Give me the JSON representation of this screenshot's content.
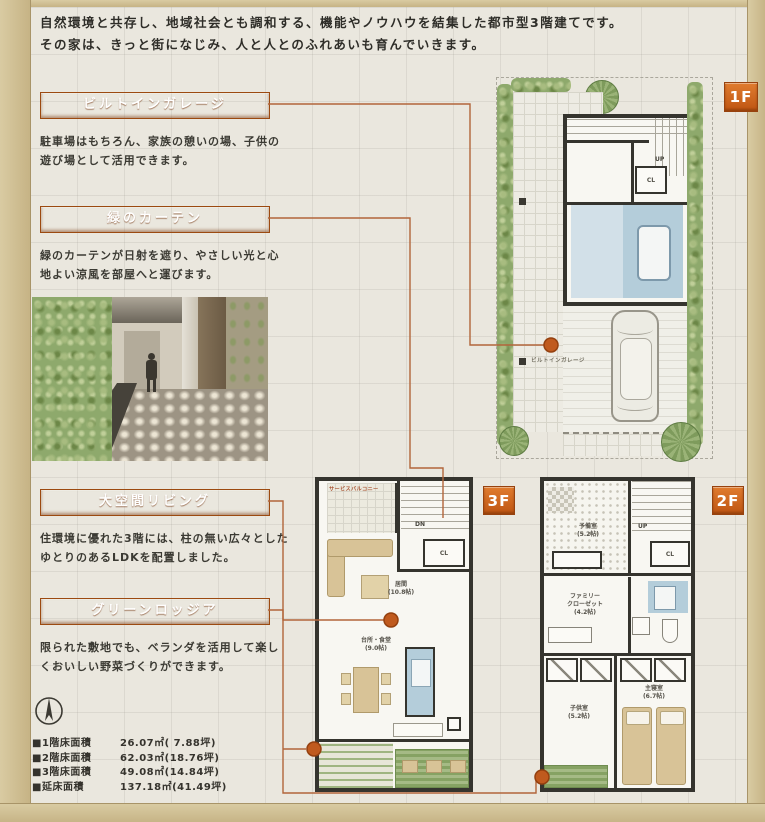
{
  "headline": {
    "line1": "自然環境と共存し、地域社会とも調和する、機能やノウハウを結集した都市型3階建てです。",
    "line2": "その家は、きっと街になじみ、人と人とのふれあいも育んでいきます。"
  },
  "features": [
    {
      "title": "ビルトインガレージ",
      "desc": "駐車場はもちろん、家族の憩いの場、子供の遊び場として活用できます。"
    },
    {
      "title": "緑のカーテン",
      "desc": "緑のカーテンが日射を遮り、やさしい光と心地よい涼風を部屋へと運びます。"
    },
    {
      "title": "大空間リビング",
      "desc": "住環境に優れた3階には、柱の無い広々としたゆとりのあるLDKを配置しました。"
    },
    {
      "title": "グリーンロッジア",
      "desc": "限られた敷地でも、ベランダを活用して楽しくおいしい野菜づくりができます。"
    }
  ],
  "floor_badges": {
    "first": "1F",
    "second": "2F",
    "third": "3F"
  },
  "plan_1f": {
    "garage": "ビルトインガレージ",
    "up": "UP",
    "cl": "CL"
  },
  "plan_3f": {
    "service_balcony": "サービスバルコニー",
    "dn": "DN",
    "cl": "CL",
    "living_name": "居間",
    "living_size": "(10.8帖)",
    "dining_name": "台所・食堂",
    "dining_size": "(9.0帖)"
  },
  "plan_2f": {
    "up": "UP",
    "cl": "CL",
    "spare_name": "予備室",
    "spare_size": "(5.2帖)",
    "closet_name_1": "ファミリー",
    "closet_name_2": "クローゼット",
    "closet_size": "(4.2帖)",
    "kids_name": "子供室",
    "kids_size": "(5.2帖)",
    "master_name": "主寝室",
    "master_size": "(6.7帖)"
  },
  "floor_areas": {
    "rows": [
      {
        "label": "■1階床面積",
        "value": "26.07㎡( 7.88坪)"
      },
      {
        "label": "■2階床面積",
        "value": "62.03㎡(18.76坪)"
      },
      {
        "label": "■3階床面積",
        "value": "49.08㎡(14.84坪)"
      },
      {
        "label": "■延床面積",
        "value": "137.18㎡(41.49坪)"
      }
    ]
  },
  "icons": {
    "compass": "compass-north-icon"
  },
  "colors": {
    "accent_orange": "#cf6020",
    "wall_dark": "#35342e",
    "wet_area_blue": "#b4cdda",
    "furniture_tan": "#d8c397",
    "greenery": "#8ea96c",
    "frame_wood": "#cdbd92"
  }
}
